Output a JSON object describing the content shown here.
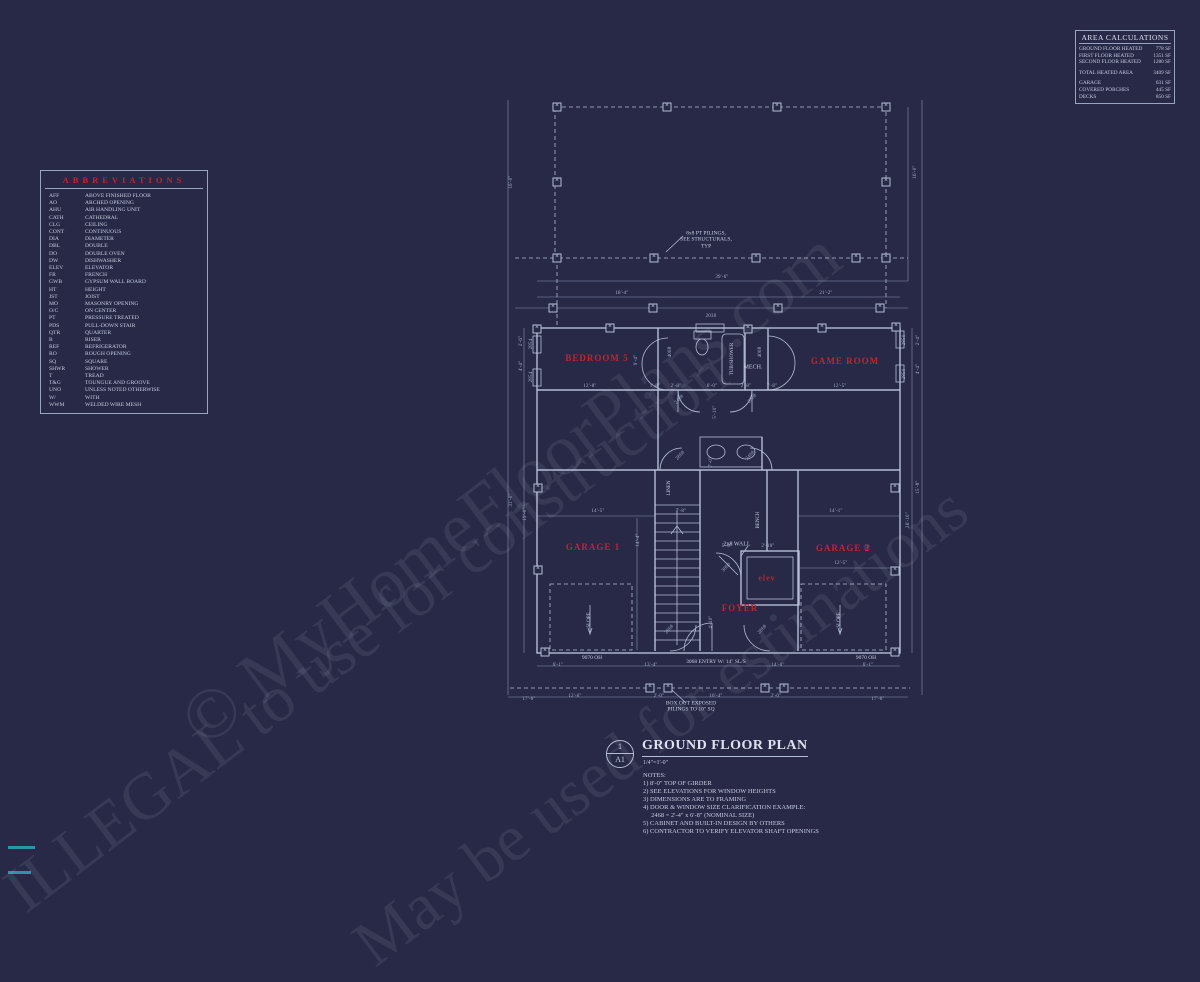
{
  "colors": {
    "background": "#272946",
    "line": "#b6bdd6",
    "red": "#c0262c",
    "teal": "#2d93a8"
  },
  "area_calculations": {
    "title": "AREA CALCULATIONS",
    "heated": [
      {
        "label": "GROUND FLOOR HEATED",
        "value": "778 SF"
      },
      {
        "label": "FIRST FLOOR HEATED",
        "value": "1351 SF"
      },
      {
        "label": "SECOND FLOOR HEATED",
        "value": "1280 SF"
      }
    ],
    "total": {
      "label": "TOTAL HEATED AREA",
      "value": "3409 SF"
    },
    "extras": [
      {
        "label": "GARAGE",
        "value": "631 SF"
      },
      {
        "label": "COVERED PORCHES",
        "value": "445 SF"
      },
      {
        "label": "DECKS",
        "value": "850 SF"
      }
    ]
  },
  "abbreviations": {
    "title": "ABBREVIATIONS",
    "items": [
      [
        "AFF",
        "ABOVE FINISHED FLOOR"
      ],
      [
        "AO",
        "ARCHED OPENING"
      ],
      [
        "AHU",
        "AIR HANDLING UNIT"
      ],
      [
        "CATH",
        "CATHEDRAL"
      ],
      [
        "CLG",
        "CEILING"
      ],
      [
        "CONT",
        "CONTINUOUS"
      ],
      [
        "DIA",
        "DIAMETER"
      ],
      [
        "DBL",
        "DOUBLE"
      ],
      [
        "DO",
        "DOUBLE OVEN"
      ],
      [
        "DW",
        "DISHWASHER"
      ],
      [
        "ELEV",
        "ELEVATOR"
      ],
      [
        "FR",
        "FRENCH"
      ],
      [
        "GWB",
        "GYPSUM WALL BOARD"
      ],
      [
        "HT",
        "HEIGHT"
      ],
      [
        "JST",
        "JOIST"
      ],
      [
        "MO",
        "MASONRY OPENING"
      ],
      [
        "O/C",
        "ON CENTER"
      ],
      [
        "PT",
        "PRESSURE TREATED"
      ],
      [
        "PDS",
        "PULL-DOWN STAIR"
      ],
      [
        "QTR",
        "QUARTER"
      ],
      [
        "R",
        "RISER"
      ],
      [
        "REF",
        "REFRIGERATOR"
      ],
      [
        "RO",
        "ROUGH OPENING"
      ],
      [
        "SQ",
        "SQUARE"
      ],
      [
        "SHWR",
        "SHOWER"
      ],
      [
        "T",
        "TREAD"
      ],
      [
        "T&G",
        "TOUNGUE AND GROOVE"
      ],
      [
        "UNO",
        "UNLESS NOTED OTHERWISE"
      ],
      [
        "W/",
        "WITH"
      ],
      [
        "WWM",
        "WELDED WIRE MESH"
      ]
    ]
  },
  "plan": {
    "room_labels": [
      {
        "t": "BEDROOM 5",
        "x": 597,
        "y": 358
      },
      {
        "t": "GAME ROOM",
        "x": 845,
        "y": 361
      },
      {
        "t": "GARAGE 1",
        "x": 593,
        "y": 547
      },
      {
        "t": "GARAGE 2",
        "x": 843,
        "y": 548
      },
      {
        "t": "FOYER",
        "x": 740,
        "y": 608
      },
      {
        "t": "elev",
        "x": 767,
        "y": 578,
        "s": 8
      }
    ],
    "annotations": [
      {
        "t": "MECH.",
        "x": 753,
        "y": 368,
        "s": 6
      },
      {
        "t": "TUB/SHOWER",
        "x": 733,
        "y": 359,
        "r": 1,
        "s": 5
      },
      {
        "t": "LINEN",
        "x": 670,
        "y": 488,
        "r": 1,
        "s": 5
      },
      {
        "t": "BENCH",
        "x": 759,
        "y": 520,
        "r": 1,
        "s": 5
      },
      {
        "t": "SLOPE",
        "x": 590,
        "y": 620,
        "r": 1,
        "s": 5
      },
      {
        "t": "SLOPE",
        "x": 840,
        "y": 620,
        "r": 1,
        "s": 5
      },
      {
        "t": "2x8 WALL",
        "x": 737,
        "y": 545,
        "s": 6
      },
      {
        "t": "9070 OH",
        "x": 592,
        "y": 658,
        "s": 5.5
      },
      {
        "t": "9070 OH",
        "x": 866,
        "y": 658,
        "s": 5.5
      },
      {
        "t": "3068 ENTRY W/ 14\" SL/S",
        "x": 716,
        "y": 662,
        "s": 5.5
      },
      {
        "t": "8x8 PT PILINGS,\nSEE STRUCTURALS,\nTYP",
        "x": 706,
        "y": 240,
        "s": 5.5,
        "n": "pilings-note"
      },
      {
        "t": "BOX OUT EXPOSED\nPILINGS TO 10\" SQ",
        "x": 691,
        "y": 707,
        "s": 5.5,
        "n": "box-out-note"
      }
    ],
    "dimensions": [
      {
        "t": "16'-0\"",
        "x": 512,
        "y": 182,
        "r": 1
      },
      {
        "t": "16'-0\"",
        "x": 916,
        "y": 172,
        "r": 1
      },
      {
        "t": "39'-6\"",
        "x": 722,
        "y": 278
      },
      {
        "t": "18'-4\"",
        "x": 622,
        "y": 294
      },
      {
        "t": "21'-2\"",
        "x": 826,
        "y": 294
      },
      {
        "t": "2030",
        "x": 711,
        "y": 317
      },
      {
        "t": "2854",
        "x": 532,
        "y": 344,
        "r": 1
      },
      {
        "t": "2'-6\"",
        "x": 522,
        "y": 341,
        "r": 1
      },
      {
        "t": "2854",
        "x": 532,
        "y": 377,
        "r": 1
      },
      {
        "t": "4'-4\"",
        "x": 522,
        "y": 366,
        "r": 1
      },
      {
        "t": "31'-0\"",
        "x": 512,
        "y": 500,
        "r": 1
      },
      {
        "t": "19'-0\"",
        "x": 526,
        "y": 514,
        "r": 1
      },
      {
        "t": "2850",
        "x": 905,
        "y": 340,
        "r": 1
      },
      {
        "t": "2'-4\"",
        "x": 919,
        "y": 340,
        "r": 1
      },
      {
        "t": "2850",
        "x": 905,
        "y": 374,
        "r": 1
      },
      {
        "t": "4'-4\"",
        "x": 919,
        "y": 369,
        "r": 1
      },
      {
        "t": "15'-8\"",
        "x": 919,
        "y": 487,
        "r": 1
      },
      {
        "t": "26'-10\"",
        "x": 909,
        "y": 520,
        "r": 1
      },
      {
        "t": "12'-8\"",
        "x": 590,
        "y": 387
      },
      {
        "t": "9'-4\"",
        "x": 637,
        "y": 360,
        "r": 1
      },
      {
        "t": "1'-8\"",
        "x": 655,
        "y": 387
      },
      {
        "t": "2'-8\"",
        "x": 676,
        "y": 387
      },
      {
        "t": "6'-0\"",
        "x": 712,
        "y": 387
      },
      {
        "t": "2'-8\"",
        "x": 746,
        "y": 387
      },
      {
        "t": "7'-8\"",
        "x": 772,
        "y": 387
      },
      {
        "t": "12'-5\"",
        "x": 840,
        "y": 387
      },
      {
        "t": "5'-10\"",
        "x": 716,
        "y": 412,
        "r": 1
      },
      {
        "t": "7'-0\"",
        "x": 712,
        "y": 462,
        "r": 1
      },
      {
        "t": "7'-8\"",
        "x": 681,
        "y": 512
      },
      {
        "t": "14'-5\"",
        "x": 598,
        "y": 512
      },
      {
        "t": "14'-4\"",
        "x": 639,
        "y": 540,
        "r": 1
      },
      {
        "t": "14'-1\"",
        "x": 836,
        "y": 512
      },
      {
        "t": "12'-5\"",
        "x": 841,
        "y": 564
      },
      {
        "t": "5'-0\"",
        "x": 727,
        "y": 547
      },
      {
        "t": "2'-10\"",
        "x": 768,
        "y": 547
      },
      {
        "t": "4'-10\"",
        "x": 712,
        "y": 622,
        "r": 1
      },
      {
        "t": "4068",
        "x": 671,
        "y": 352,
        "r": 1
      },
      {
        "t": "4068",
        "x": 761,
        "y": 352,
        "r": 1
      },
      {
        "t": "2468",
        "x": 680,
        "y": 400,
        "d": 1
      },
      {
        "t": "2868",
        "x": 753,
        "y": 399,
        "d": 1
      },
      {
        "t": "2868",
        "x": 681,
        "y": 456,
        "d": 1
      },
      {
        "t": "2468",
        "x": 751,
        "y": 456,
        "d": 1
      },
      {
        "t": "3068",
        "x": 727,
        "y": 568,
        "d": 1
      },
      {
        "t": "2868",
        "x": 670,
        "y": 630,
        "d": 1
      },
      {
        "t": "2868",
        "x": 763,
        "y": 630,
        "d": 1
      },
      {
        "t": "6'-1\"",
        "x": 558,
        "y": 666
      },
      {
        "t": "13'-4\"",
        "x": 651,
        "y": 666
      },
      {
        "t": "14'-0\"",
        "x": 778,
        "y": 666
      },
      {
        "t": "6'-1\"",
        "x": 868,
        "y": 666
      },
      {
        "t": "17'-6\"",
        "x": 529,
        "y": 700
      },
      {
        "t": "12'-6\"",
        "x": 575,
        "y": 697
      },
      {
        "t": "2'-0\"",
        "x": 659,
        "y": 697
      },
      {
        "t": "10'-4\"",
        "x": 716,
        "y": 697
      },
      {
        "t": "2'-0\"",
        "x": 776,
        "y": 697
      },
      {
        "t": "17'-6\"",
        "x": 878,
        "y": 700
      }
    ],
    "pilings": [
      [
        557,
        107
      ],
      [
        667,
        107
      ],
      [
        777,
        107
      ],
      [
        886,
        107
      ],
      [
        557,
        182
      ],
      [
        886,
        182
      ],
      [
        557,
        258
      ],
      [
        654,
        258
      ],
      [
        756,
        258
      ],
      [
        856,
        258
      ],
      [
        886,
        258
      ],
      [
        553,
        308
      ],
      [
        653,
        308
      ],
      [
        778,
        308
      ],
      [
        880,
        308
      ],
      [
        537,
        329
      ],
      [
        610,
        328
      ],
      [
        748,
        329
      ],
      [
        822,
        328
      ],
      [
        896,
        327
      ],
      [
        538,
        488
      ],
      [
        895,
        488
      ],
      [
        538,
        570
      ],
      [
        895,
        571
      ],
      [
        545,
        652
      ],
      [
        895,
        652
      ],
      [
        650,
        688
      ],
      [
        668,
        688
      ],
      [
        765,
        688
      ],
      [
        784,
        688
      ]
    ]
  },
  "title_block": {
    "detail_number": "1",
    "sheet": "A1",
    "title": "GROUND FLOOR PLAN",
    "scale": "1/4\"=1'-0\"",
    "notes_title": "NOTES:",
    "notes": [
      "1) 8'-0\" TOP OF GIRDER",
      "2) SEE ELEVATIONS FOR WINDOW HEIGHTS",
      "3) DIMENSIONS ARE TO FRAMING",
      "4) DOOR & WINDOW SIZE CLARIFICATION EXAMPLE:",
      "     2468 = 2'-4\" x 6'-8\" (NOMINAL SIZE)",
      "5) CABINET AND BUILT-IN DESIGN BY OTHERS",
      "6) CONTRACTOR TO VERIFY ELEVATOR SHAFT OPENINGS"
    ]
  },
  "watermark": {
    "lines": [
      "© MyHomeFloorPlans.com",
      "ILLEGAL to use for construction",
      "May be used for estimations"
    ]
  }
}
